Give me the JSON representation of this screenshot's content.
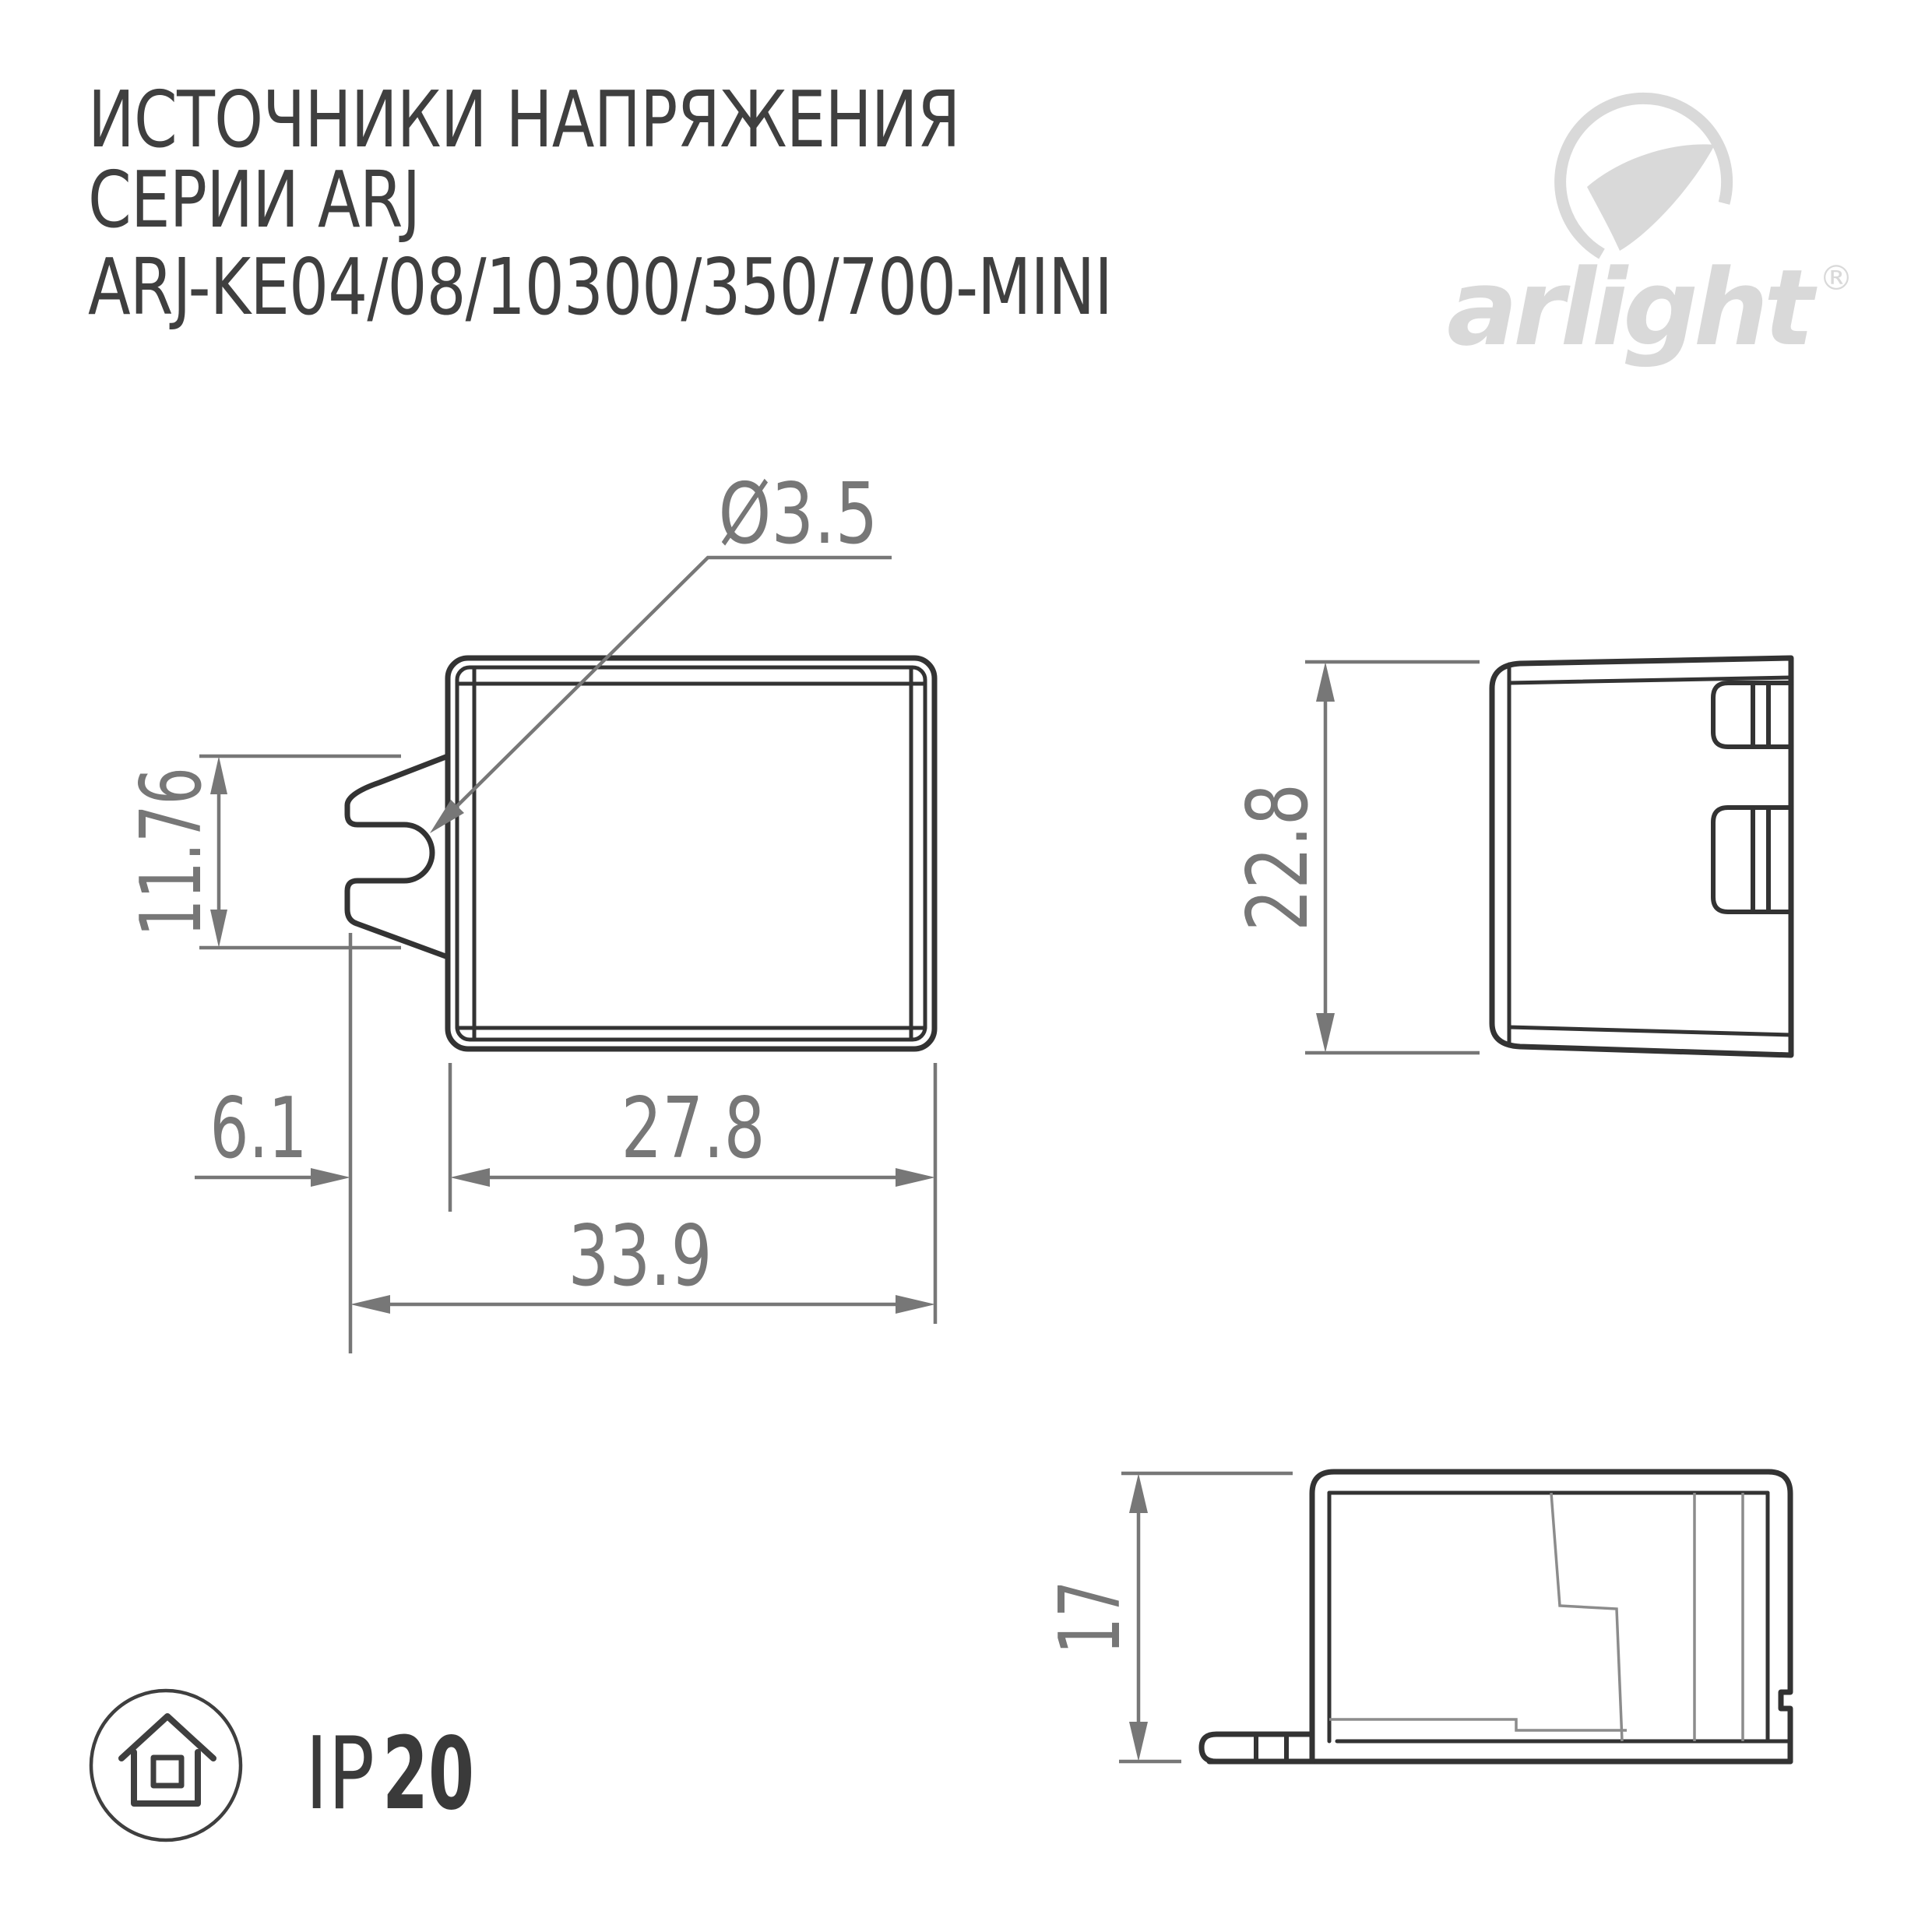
{
  "header": {
    "title_line1": "ИСТОЧНИКИ НАПРЯЖЕНИЯ",
    "title_line2": "СЕРИИ ARJ",
    "title_line3": "ARJ-KE04/08/10300/350/700-MINI"
  },
  "logo": {
    "brand": "arlight",
    "registered_mark": "®",
    "icon": "arlight-swoosh-icon",
    "color": "#d9d9d9"
  },
  "drawing": {
    "front_view": {
      "hole_diameter_label": "Ø3.5",
      "clip_height_label": "11.76",
      "clip_offset_label": "6.1",
      "body_width_label": "27.8",
      "total_width_label": "33.9"
    },
    "side_view": {
      "height_label": "22.8"
    },
    "profile_view": {
      "depth_label": "17"
    },
    "colors": {
      "outline_dark": "#333333",
      "dimension_gray": "#777777",
      "internal_gray": "#8c8c8c",
      "title_text": "#3f3f3f",
      "background": "#ffffff"
    }
  },
  "footer": {
    "ip_icon": "house-in-circle-icon",
    "ip_prefix": "IP",
    "ip_value": "20"
  }
}
